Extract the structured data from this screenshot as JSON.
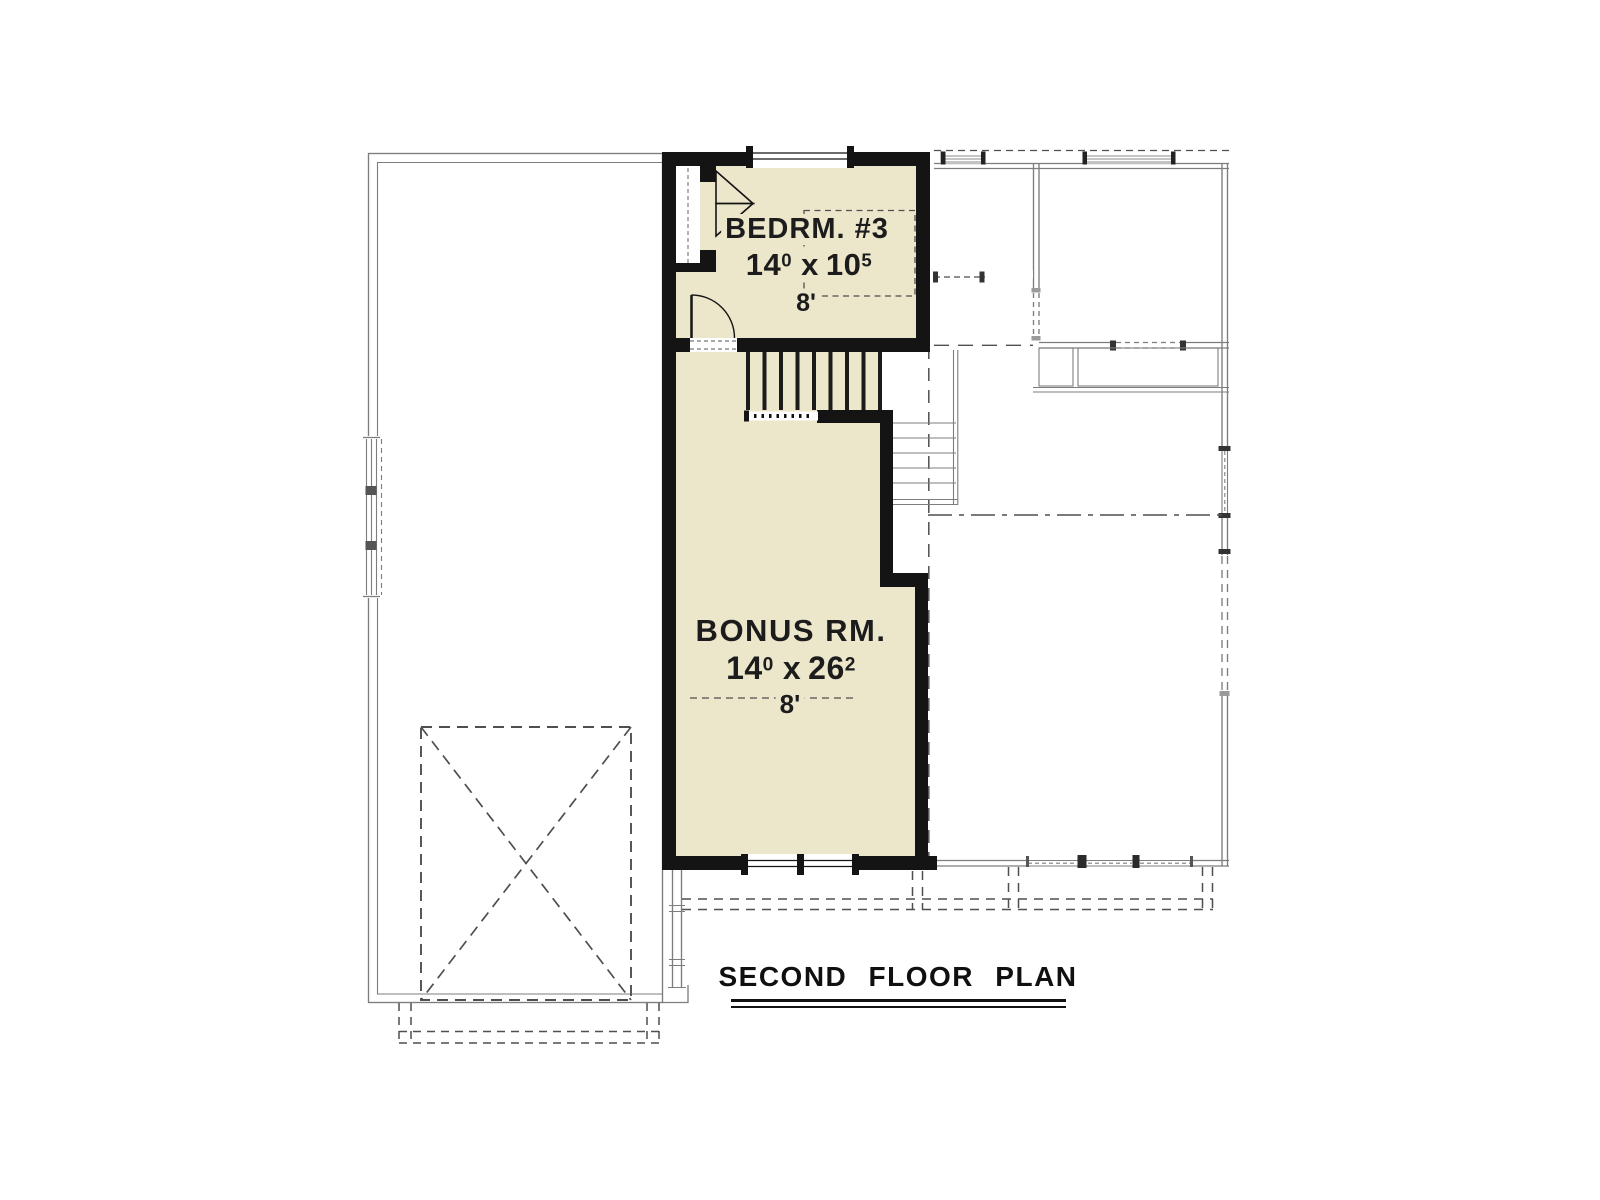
{
  "plan": {
    "title": "SECOND FLOOR PLAN",
    "rooms": [
      {
        "id": "bedroom3",
        "label": "BEDRM. #3",
        "dim_w": "14",
        "dim_w_sup": "0",
        "dim_sep": "x",
        "dim_l": "10",
        "dim_l_sup": "5",
        "ceiling_height": "8'"
      },
      {
        "id": "bonus",
        "label": "BONUS RM.",
        "dim_w": "14",
        "dim_w_sup": "0",
        "dim_sep": "x",
        "dim_l": "26",
        "dim_l_sup": "2",
        "ceiling_height": "8'"
      }
    ],
    "colors": {
      "room_fill": "#ece7cb",
      "wall": "#141414",
      "lower_floor": "#7d7d7d",
      "dashed": "#4f4f4f",
      "background": "#ffffff",
      "text": "#1c1c1c"
    }
  }
}
